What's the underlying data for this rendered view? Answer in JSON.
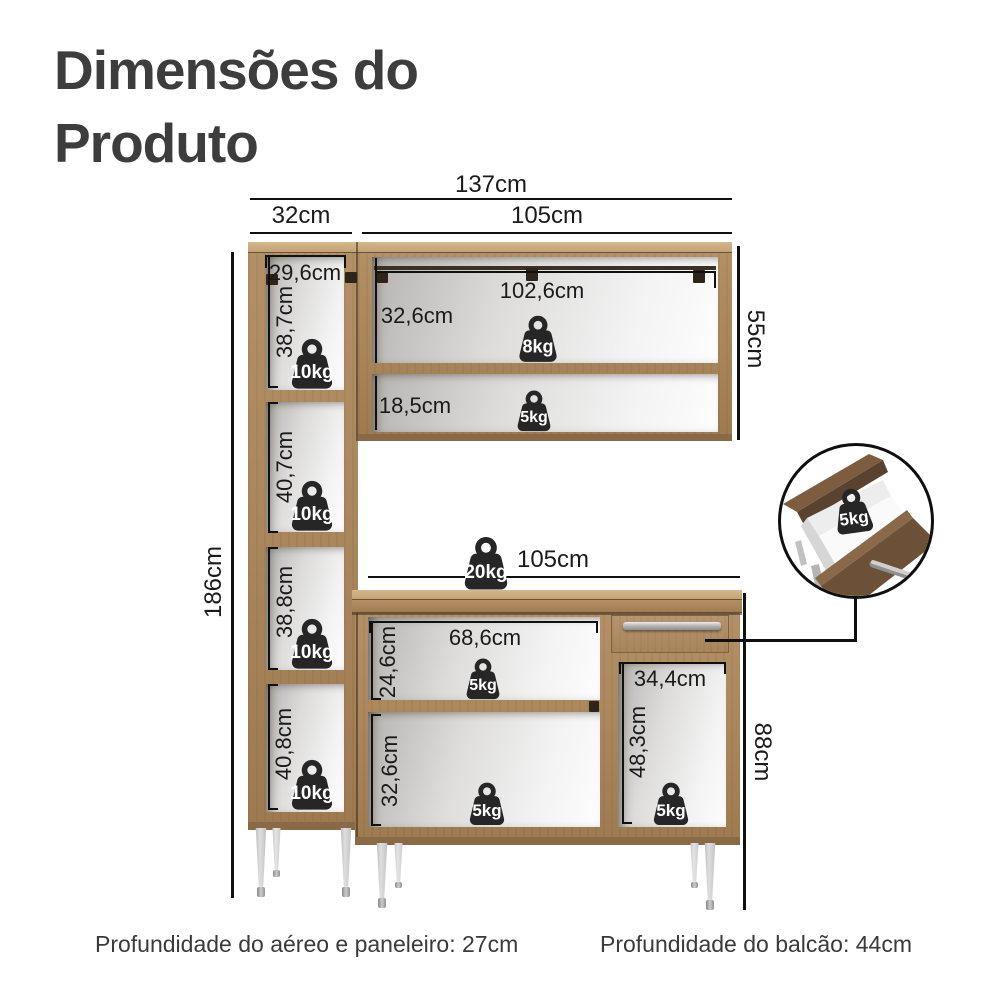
{
  "title": {
    "line1": "Dimensões do",
    "line2": "Produto"
  },
  "footer": {
    "left": "Profundidade do aéreo e paneleiro: 27cm",
    "right": "Profundidade do balcão: 44cm"
  },
  "colors": {
    "wood": "#a8855b",
    "wood_top": "#c9aa80",
    "inset_wood": "#6d5038",
    "line": "#101010",
    "weight_badge": "#262626",
    "title_text": "#3d3d3d"
  },
  "dims": {
    "overall_width": "137cm",
    "tall_width": "32cm",
    "upper_width": "105cm",
    "tall_inner_width": "29,6cm",
    "tall_section1": "38,7cm",
    "tall_section2": "40,7cm",
    "tall_section3": "38,8cm",
    "tall_section4": "40,8cm",
    "overall_height": "186cm",
    "upper_inner_width": "102,6cm",
    "upper_section1": "32,6cm",
    "upper_section2": "18,5cm",
    "upper_height": "55cm",
    "counter_width": "105cm",
    "counter_inner_width": "68,6cm",
    "counter_section1": "24,6cm",
    "counter_section2": "32,6cm",
    "cubby_width": "34,4cm",
    "cubby_height": "48,3cm",
    "counter_height": "88cm"
  },
  "capacities": {
    "tall_shelf1": "10kg",
    "tall_shelf2": "10kg",
    "tall_shelf3": "10kg",
    "tall_shelf4": "10kg",
    "upper_shelf1": "8kg",
    "upper_shelf2": "5kg",
    "counter_top": "20kg",
    "counter_shelf1": "5kg",
    "counter_shelf2": "5kg",
    "cubby_shelf": "5kg",
    "drawer": "5kg"
  }
}
